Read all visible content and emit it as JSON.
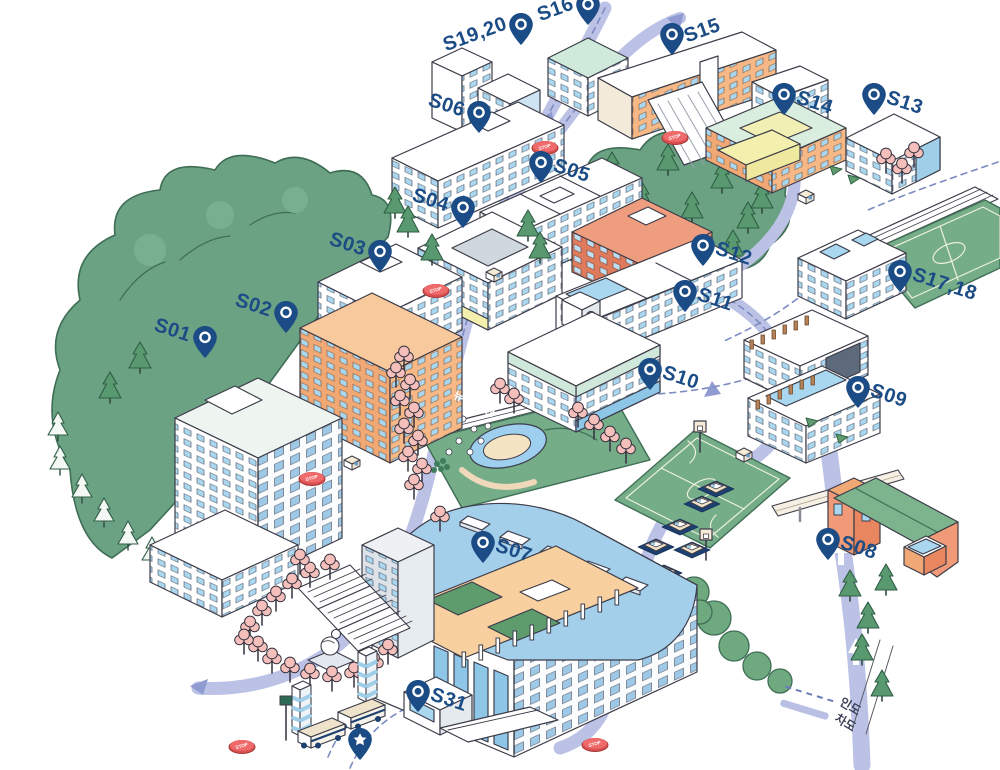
{
  "map_title": "campus-illustrated-map",
  "park": {
    "label": "뉴턴공원"
  },
  "stop_label": "STOP",
  "legend": {
    "items": [
      {
        "id": "sidewalk",
        "label": "인도",
        "line": "dashed"
      },
      {
        "id": "roadway",
        "label": "차도",
        "line": "solid"
      }
    ]
  },
  "colors": {
    "pin_navy": "#1b4c85",
    "road": "#bcc2e6",
    "forest": "#6ba284",
    "window_blue": "#a9d7f0",
    "brick": "#ea8e70",
    "orange": "#f5b886",
    "vault_roof": "#a3cfeb",
    "green_roof": "#7db48e",
    "stop_red": "#ef6a6a",
    "cherry_pink": "#f5c0bc"
  },
  "markers": [
    {
      "id": "S01",
      "label": "S01",
      "x": 205,
      "y": 358,
      "side": "left",
      "rot": 18
    },
    {
      "id": "S02",
      "label": "S02",
      "x": 286,
      "y": 333,
      "side": "left",
      "rot": 18
    },
    {
      "id": "S03",
      "label": "S03",
      "x": 380,
      "y": 272,
      "side": "left",
      "rot": 18
    },
    {
      "id": "S04",
      "label": "S04",
      "x": 463,
      "y": 228,
      "side": "left",
      "rot": 18
    },
    {
      "id": "S05",
      "label": "S05",
      "x": 541,
      "y": 183,
      "side": "right",
      "rot": 18
    },
    {
      "id": "S06",
      "label": "S06",
      "x": 479,
      "y": 133,
      "side": "left",
      "rot": 18
    },
    {
      "id": "S07",
      "label": "S07",
      "x": 483,
      "y": 563,
      "side": "right",
      "rot": 18
    },
    {
      "id": "S08",
      "label": "S08",
      "x": 828,
      "y": 560,
      "side": "right",
      "rot": 18
    },
    {
      "id": "S09",
      "label": "S09",
      "x": 858,
      "y": 408,
      "side": "right",
      "rot": 18
    },
    {
      "id": "S10",
      "label": "S10",
      "x": 650,
      "y": 390,
      "side": "right",
      "rot": 18
    },
    {
      "id": "S11",
      "label": "S11",
      "x": 685,
      "y": 312,
      "side": "right",
      "rot": 18
    },
    {
      "id": "S12",
      "label": "S12",
      "x": 703,
      "y": 266,
      "side": "right",
      "rot": 18
    },
    {
      "id": "S13",
      "label": "S13",
      "x": 874,
      "y": 115,
      "side": "right",
      "rot": 18
    },
    {
      "id": "S14",
      "label": "S14",
      "x": 784,
      "y": 115,
      "side": "right",
      "rot": 18
    },
    {
      "id": "S15",
      "label": "S15",
      "x": 672,
      "y": 55,
      "side": "right",
      "rot": -20
    },
    {
      "id": "S16",
      "label": "S16",
      "x": 588,
      "y": 25,
      "side": "left",
      "rot": -20
    },
    {
      "id": "S17.18",
      "label": "S17,18",
      "x": 900,
      "y": 292,
      "side": "right",
      "rot": 18
    },
    {
      "id": "S19.20",
      "label": "S19,20",
      "x": 521,
      "y": 45,
      "side": "left",
      "rot": -20
    },
    {
      "id": "S31",
      "label": "S31",
      "x": 418,
      "y": 712,
      "side": "right",
      "rot": 18
    },
    {
      "id": "star",
      "label": "",
      "x": 360,
      "y": 760,
      "side": "right",
      "rot": 0,
      "type": "star"
    }
  ]
}
